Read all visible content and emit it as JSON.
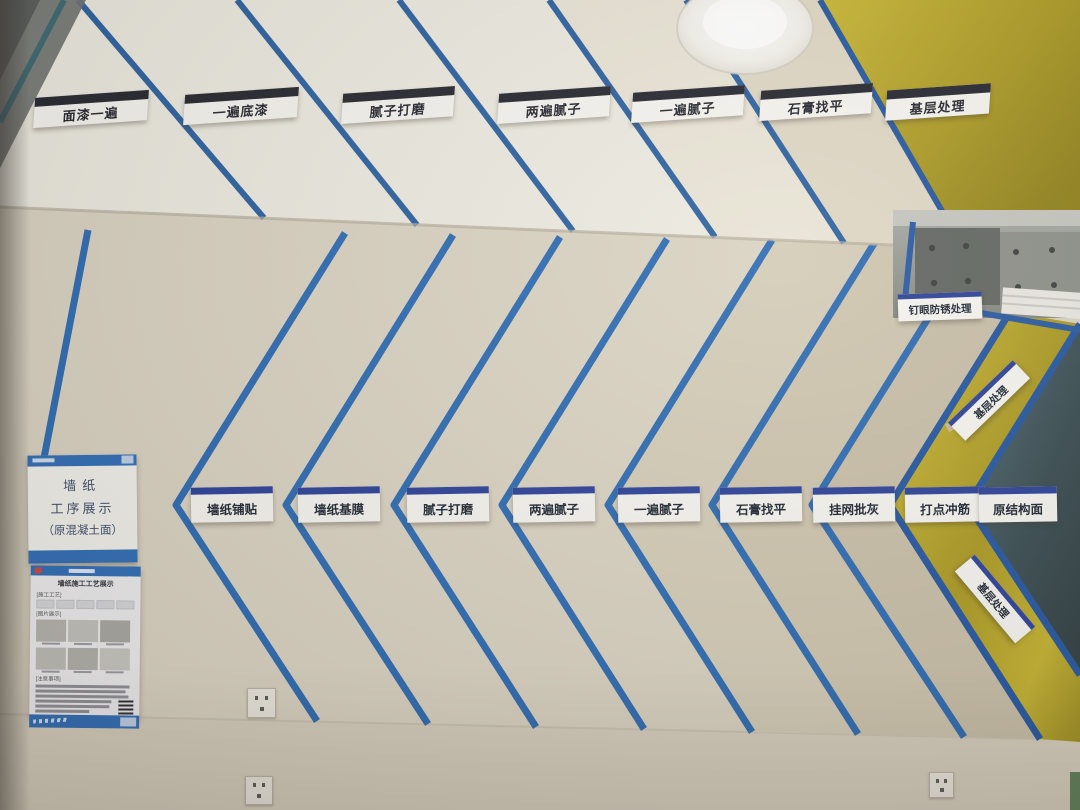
{
  "scene_title": "墙纸工序展示墙（施工工艺样板照片）",
  "ceiling_labels": [
    {
      "text": "面漆一遍"
    },
    {
      "text": "一遍底漆"
    },
    {
      "text": "腻子打磨"
    },
    {
      "text": "两遍腻子"
    },
    {
      "text": "一遍腻子"
    },
    {
      "text": "石膏找平"
    },
    {
      "text": "基层处理"
    }
  ],
  "wall_labels": [
    {
      "text": "墙纸铺贴"
    },
    {
      "text": "墙纸基膜"
    },
    {
      "text": "腻子打磨"
    },
    {
      "text": "两遍腻子"
    },
    {
      "text": "一遍腻子"
    },
    {
      "text": "石膏找平"
    },
    {
      "text": "挂网批灰"
    },
    {
      "text": "打点冲筋"
    },
    {
      "text": "原结构面"
    }
  ],
  "corner_labels": {
    "nail_rust": "钉眼防锈处理",
    "upper_base": "基层处理",
    "lower_base": "基层处理"
  },
  "sign": {
    "line1": "墙纸",
    "line2": "工序展示",
    "line3": "（原混凝土面）"
  },
  "poster": {
    "title": "墙纸施工工艺展示",
    "sec_process": "[施工工艺]",
    "sec_photos": "[图片展示]",
    "sec_notes": "[注意事项]"
  },
  "colors": {
    "tape_blue": "#2b69b0",
    "dark_tape_blue": "#22549e",
    "insulation_yellow": "#bfab25",
    "raw_structure_teal": "#42575f",
    "wall_cream": "#d9d2c1",
    "ceiling_white": "#eceadf",
    "plaque_bar_ceiling": "#23242c",
    "plaque_bar_wall": "#2a3f96"
  }
}
